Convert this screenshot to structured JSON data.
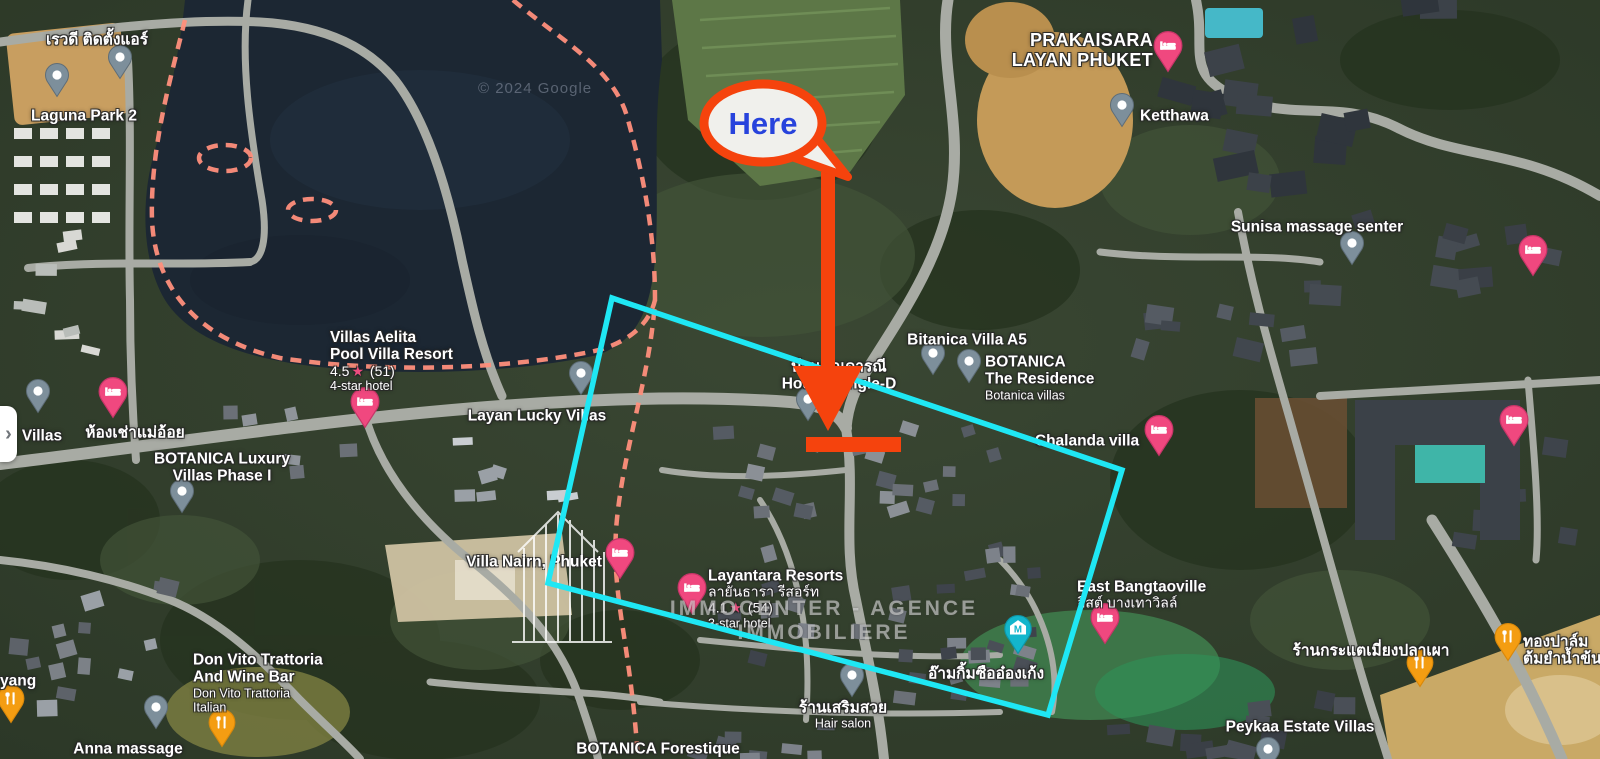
{
  "map": {
    "attribution": "© 2024 Google",
    "watermark": "IMMOCENTER - AGENCE IMMOBILIERE",
    "panel_toggle_glyph": "›"
  },
  "annotations": {
    "here_label": "Here",
    "colors": {
      "callout_red": "#F5430D",
      "highlight_cyan": "#1FE7F4",
      "here_text_blue": "#2743DC",
      "boundary_dash_pink": "#FF8F7C"
    }
  },
  "pin_colors": {
    "gray": "#7D8F9B",
    "hotel_pink": "#F0487F",
    "restaurant_orange": "#F49D12",
    "shrine_teal": "#13B6CC"
  },
  "places": [
    {
      "name": "revadee-air-service",
      "pin": {
        "type": "gray",
        "x": 120,
        "y": 58
      },
      "label": {
        "x": 97,
        "y": 40,
        "align": "c",
        "lines": [
          {
            "t": "เรวดี ติดตั้งแอร์",
            "s": "title"
          }
        ]
      }
    },
    {
      "name": "laguna-park-2",
      "pin": {
        "type": "gray",
        "x": 57,
        "y": 76
      },
      "label": {
        "x": 84,
        "y": 116,
        "align": "c",
        "lines": [
          {
            "t": "Laguna Park 2",
            "s": "title"
          }
        ]
      }
    },
    {
      "name": "prakaisara-layan-phuket",
      "pin": {
        "type": "pink",
        "x": 1168,
        "y": 44
      },
      "label": {
        "x": 1153,
        "y": 50,
        "align": "r",
        "lines": [
          {
            "t": "PRAKAISARA",
            "s": "big"
          },
          {
            "t": "LAYAN PHUKET",
            "s": "big"
          }
        ]
      }
    },
    {
      "name": "ketthawa",
      "pin": {
        "type": "gray",
        "x": 1122,
        "y": 106
      },
      "label": {
        "x": 1140,
        "y": 116,
        "align": "l",
        "lines": [
          {
            "t": "Ketthawa",
            "s": "title"
          }
        ]
      }
    },
    {
      "name": "sunisa-massage-senter",
      "pin": {
        "type": "gray",
        "x": 1352,
        "y": 244
      },
      "label": {
        "x": 1317,
        "y": 227,
        "align": "c",
        "lines": [
          {
            "t": "Sunisa massage senter",
            "s": "title"
          }
        ]
      }
    },
    {
      "name": "hotel-pin-right-top",
      "pin": {
        "type": "pink",
        "x": 1533,
        "y": 248
      },
      "label": null
    },
    {
      "name": "villas-aelita-pool-villa-resort",
      "pin": {
        "type": "pink",
        "x": 365,
        "y": 400
      },
      "label": {
        "x": 330,
        "y": 361,
        "align": "l",
        "lines": [
          {
            "t": "Villas Aelita",
            "s": "title"
          },
          {
            "t": "Pool Villa Resort",
            "s": "title"
          },
          {
            "t": "4.5",
            "count": "(51)",
            "s": "rating"
          },
          {
            "t": "4-star hotel",
            "s": "sub"
          }
        ]
      }
    },
    {
      "name": "layan-lucky-villas",
      "pin": {
        "type": "gray",
        "x": 581,
        "y": 374
      },
      "label": {
        "x": 537,
        "y": 416,
        "align": "c",
        "lines": [
          {
            "t": "Layan Lucky Villas",
            "s": "title"
          }
        ]
      }
    },
    {
      "name": "villas-left-edge",
      "pin": {
        "type": "gray",
        "x": 38,
        "y": 392
      },
      "label": {
        "x": 42,
        "y": 436,
        "align": "c",
        "lines": [
          {
            "t": "Villas",
            "s": "title"
          }
        ]
      }
    },
    {
      "name": "hong-chao-mae-oi",
      "pin": {
        "type": "pink",
        "x": 113,
        "y": 390
      },
      "label": {
        "x": 135,
        "y": 433,
        "align": "c",
        "lines": [
          {
            "t": "ห้องเช่าแม่อ้อย",
            "s": "title"
          }
        ]
      }
    },
    {
      "name": "botanica-luxury-villas-phase-1",
      "pin": {
        "type": "gray",
        "x": 182,
        "y": 492
      },
      "label": {
        "x": 222,
        "y": 468,
        "align": "c",
        "lines": [
          {
            "t": "BOTANICA Luxury",
            "s": "title"
          },
          {
            "t": "Villas Phase I",
            "s": "title"
          }
        ]
      }
    },
    {
      "name": "bitanica-villa-a5",
      "pin": {
        "type": "gray",
        "x": 933,
        "y": 354
      },
      "label": {
        "x": 967,
        "y": 340,
        "align": "c",
        "lines": [
          {
            "t": "Bitanica Villa A5",
            "s": "title"
          }
        ]
      }
    },
    {
      "name": "botanica-the-residence",
      "pin": {
        "type": "gray",
        "x": 969,
        "y": 362
      },
      "label": {
        "x": 985,
        "y": 378,
        "align": "l",
        "lines": [
          {
            "t": "BOTANICA",
            "s": "title"
          },
          {
            "t": "The Residence",
            "s": "title"
          },
          {
            "t": "Botanica villas",
            "s": "sub"
          }
        ]
      }
    },
    {
      "name": "baan-khun-daranee-house",
      "pin": {
        "type": "gray",
        "x": 808,
        "y": 400
      },
      "label": {
        "x": 839,
        "y": 376,
        "align": "c",
        "lines": [
          {
            "t": "บ้านคุณดารณี",
            "s": "title"
          },
          {
            "t": "House Single-D",
            "s": "title"
          }
        ]
      }
    },
    {
      "name": "chalanda-villa",
      "pin": {
        "type": "pink",
        "x": 1159,
        "y": 428
      },
      "label": {
        "x": 1087,
        "y": 441,
        "align": "c",
        "lines": [
          {
            "t": "Chalanda villa",
            "s": "title"
          }
        ]
      }
    },
    {
      "name": "villa-nairn-phuket",
      "pin": {
        "type": "pink",
        "x": 620,
        "y": 551
      },
      "label": {
        "x": 534,
        "y": 562,
        "align": "c",
        "lines": [
          {
            "t": "Villa Nairn, Phuket",
            "s": "title"
          }
        ]
      }
    },
    {
      "name": "layantara-resorts",
      "pin": {
        "type": "pink",
        "x": 692,
        "y": 586
      },
      "label": {
        "x": 708,
        "y": 599,
        "align": "l",
        "lines": [
          {
            "t": "Layantara Resorts",
            "s": "title"
          },
          {
            "t": "ลายันธารา รีสอร์ท",
            "s": "subthai"
          },
          {
            "t": "4.1",
            "count": "(54)",
            "s": "rating"
          },
          {
            "t": "3-star hotel",
            "s": "sub"
          }
        ]
      }
    },
    {
      "name": "east-bangtaoville",
      "pin": {
        "type": "pink",
        "x": 1105,
        "y": 616
      },
      "label": {
        "x": 1077,
        "y": 595,
        "align": "l",
        "lines": [
          {
            "t": "East Bangtaoville",
            "s": "title"
          },
          {
            "t": "อีสต์ บางเทาวิลล์",
            "s": "subthai"
          }
        ]
      }
    },
    {
      "name": "am-kim-sue-ong-keng-shrine",
      "pin": {
        "type": "teal",
        "x": 1018,
        "y": 628
      },
      "label": {
        "x": 986,
        "y": 674,
        "align": "c",
        "lines": [
          {
            "t": "อ๊ามกิ้มซืออ๋องเก้ง",
            "s": "title"
          }
        ]
      }
    },
    {
      "name": "hair-salon",
      "pin": {
        "type": "gray",
        "x": 852,
        "y": 676
      },
      "label": {
        "x": 843,
        "y": 715,
        "align": "c",
        "lines": [
          {
            "t": "ร้านเสริมสวย",
            "s": "title"
          },
          {
            "t": "Hair salon",
            "s": "sub"
          }
        ]
      }
    },
    {
      "name": "peykaa-estate-villas",
      "pin": {
        "type": "gray",
        "x": 1268,
        "y": 750
      },
      "label": {
        "x": 1300,
        "y": 727,
        "align": "c",
        "lines": [
          {
            "t": "Peykaa Estate Villas",
            "s": "title"
          }
        ]
      }
    },
    {
      "name": "don-vito-trattoria",
      "pin": {
        "type": "orange",
        "x": 222,
        "y": 722
      },
      "label": {
        "x": 193,
        "y": 683,
        "align": "l",
        "lines": [
          {
            "t": "Don Vito Trattoria",
            "s": "title"
          },
          {
            "t": "And Wine Bar",
            "s": "title"
          },
          {
            "t": "Don Vito Trattoria",
            "s": "sub"
          },
          {
            "t": "Italian",
            "s": "sub"
          }
        ]
      }
    },
    {
      "name": "anna-massage",
      "pin": {
        "type": "gray",
        "x": 156,
        "y": 708
      },
      "label": {
        "x": 128,
        "y": 749,
        "align": "c",
        "lines": [
          {
            "t": "Anna massage",
            "s": "title"
          }
        ]
      }
    },
    {
      "name": "yang-left-edge",
      "pin": {
        "type": "orange",
        "x": 11,
        "y": 698
      },
      "label": {
        "x": 0,
        "y": 681,
        "align": "l",
        "lines": [
          {
            "t": "yang",
            "s": "title"
          }
        ]
      }
    },
    {
      "name": "krataek-miang-pla-phao",
      "pin": {
        "type": "orange",
        "x": 1420,
        "y": 662
      },
      "label": {
        "x": 1371,
        "y": 651,
        "align": "c",
        "lines": [
          {
            "t": "ร้านกระแตเมี่ยงปลาเผา",
            "s": "title"
          }
        ]
      }
    },
    {
      "name": "thong-palm-tom-yum",
      "pin": {
        "type": "orange",
        "x": 1508,
        "y": 636
      },
      "label": {
        "x": 1523,
        "y": 651,
        "align": "l",
        "lines": [
          {
            "t": "ทองปาล์ม",
            "s": "title"
          },
          {
            "t": "ต้มยำน้ำข้น",
            "s": "title"
          }
        ]
      }
    },
    {
      "name": "hotel-pin-right-mid",
      "pin": {
        "type": "pink",
        "x": 1514,
        "y": 418
      },
      "label": null
    },
    {
      "name": "botanica-forestique",
      "pin": null,
      "label": {
        "x": 658,
        "y": 749,
        "align": "c",
        "lines": [
          {
            "t": "BOTANICA Forestique",
            "s": "title"
          }
        ]
      }
    }
  ]
}
